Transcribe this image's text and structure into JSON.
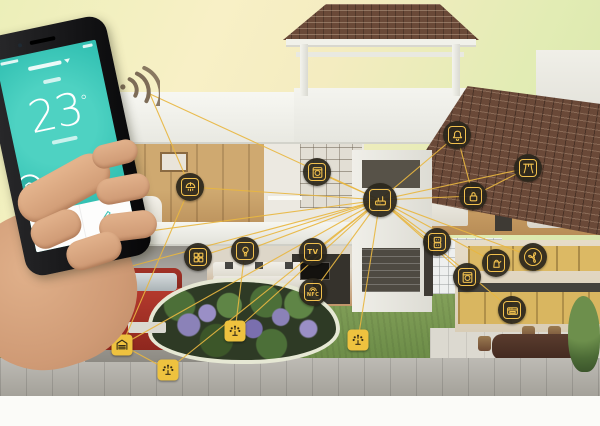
{
  "scene": {
    "width": 600,
    "height": 426,
    "description": "smart-home cutaway house with connected device icons and phone app"
  },
  "colors": {
    "line": "#e8b640",
    "icon_yellow": "#f2c14e",
    "icon_dark_bg": "#2a261b",
    "app_teal": "#35c2b4",
    "roof_tile": "#6a4938"
  },
  "phone": {
    "screen": {
      "temperature": "23",
      "unit": "°"
    }
  },
  "icons": [
    {
      "id": "hub",
      "name": "smart-hub",
      "style": "circle",
      "glyph": "hub",
      "x": 380,
      "y": 200
    },
    {
      "id": "camera",
      "name": "security-camera",
      "style": "circle",
      "glyph": "camera",
      "x": 113,
      "y": 236
    },
    {
      "id": "plug",
      "name": "power-plug",
      "style": "circle",
      "glyph": "plug",
      "x": 49,
      "y": 288
    },
    {
      "id": "garage",
      "name": "garage-door",
      "style": "square",
      "glyph": "garage",
      "x": 122,
      "y": 345
    },
    {
      "id": "sprinkler-left",
      "name": "garden-sprinkler-left",
      "style": "square",
      "glyph": "sprinkler",
      "x": 168,
      "y": 370
    },
    {
      "id": "ceiling-light",
      "name": "bedroom-ceiling-light",
      "style": "circle",
      "glyph": "chandelier",
      "x": 190,
      "y": 187
    },
    {
      "id": "study-appliance",
      "name": "study-appliance",
      "style": "circle",
      "glyph": "appliance",
      "x": 317,
      "y": 172
    },
    {
      "id": "switch-panel",
      "name": "switch-panel",
      "style": "circle",
      "glyph": "panel",
      "x": 198,
      "y": 257
    },
    {
      "id": "bulb",
      "name": "light-bulb",
      "style": "circle",
      "glyph": "bulb",
      "x": 245,
      "y": 251
    },
    {
      "id": "tv",
      "name": "smart-tv",
      "style": "circle",
      "glyph": "tv",
      "label": "TV",
      "x": 313,
      "y": 252
    },
    {
      "id": "nfc",
      "name": "nfc-sensor",
      "style": "circle",
      "glyph": "nfc",
      "label": "NFC",
      "x": 313,
      "y": 292
    },
    {
      "id": "irrigation",
      "name": "garden-irrigation",
      "style": "square",
      "glyph": "sprinkler",
      "x": 235,
      "y": 331
    },
    {
      "id": "sprinkler-right",
      "name": "garden-sprinkler-right",
      "style": "square",
      "glyph": "sprinkler",
      "x": 358,
      "y": 340
    },
    {
      "id": "alarm",
      "name": "alarm-bell",
      "style": "circle",
      "glyph": "bell",
      "x": 457,
      "y": 135
    },
    {
      "id": "curtain",
      "name": "smart-curtain",
      "style": "circle",
      "glyph": "curtain",
      "x": 528,
      "y": 168
    },
    {
      "id": "lock",
      "name": "door-lock",
      "style": "circle",
      "glyph": "lock",
      "x": 473,
      "y": 196
    },
    {
      "id": "socket",
      "name": "wall-socket",
      "style": "circle",
      "glyph": "socket",
      "x": 437,
      "y": 242
    },
    {
      "id": "fan",
      "name": "exhaust-fan",
      "style": "circle",
      "glyph": "fan",
      "x": 533,
      "y": 257
    },
    {
      "id": "kettle",
      "name": "smart-kettle",
      "style": "circle",
      "glyph": "kettle",
      "x": 496,
      "y": 263
    },
    {
      "id": "washing",
      "name": "washing-machine",
      "style": "circle",
      "glyph": "appliance",
      "x": 467,
      "y": 277
    },
    {
      "id": "oven",
      "name": "smart-oven",
      "style": "circle",
      "glyph": "oven",
      "x": 512,
      "y": 310
    }
  ],
  "anchors": {
    "phone-wifi": {
      "x": 150,
      "y": 94
    }
  },
  "connections": [
    [
      "hub",
      "camera"
    ],
    [
      "hub",
      "plug"
    ],
    [
      "hub",
      "garage"
    ],
    [
      "hub",
      "sprinkler-left"
    ],
    [
      "hub",
      "ceiling-light"
    ],
    [
      "hub",
      "study-appliance"
    ],
    [
      "hub",
      "switch-panel"
    ],
    [
      "hub",
      "bulb"
    ],
    [
      "hub",
      "tv"
    ],
    [
      "hub",
      "nfc"
    ],
    [
      "hub",
      "irrigation"
    ],
    [
      "hub",
      "sprinkler-right"
    ],
    [
      "hub",
      "alarm"
    ],
    [
      "hub",
      "curtain"
    ],
    [
      "hub",
      "lock"
    ],
    [
      "hub",
      "socket"
    ],
    [
      "hub",
      "fan"
    ],
    [
      "hub",
      "kettle"
    ],
    [
      "hub",
      "washing"
    ],
    [
      "hub",
      "oven"
    ],
    [
      "hub",
      "phone-wifi"
    ],
    [
      "camera",
      "garage"
    ],
    [
      "ceiling-light",
      "garage"
    ],
    [
      "plug",
      "garage"
    ],
    [
      "sprinkler-left",
      "garage"
    ],
    [
      "alarm",
      "lock"
    ],
    [
      "curtain",
      "lock"
    ],
    [
      "bulb",
      "irrigation"
    ],
    [
      "ceiling-light",
      "phone-wifi"
    ]
  ]
}
